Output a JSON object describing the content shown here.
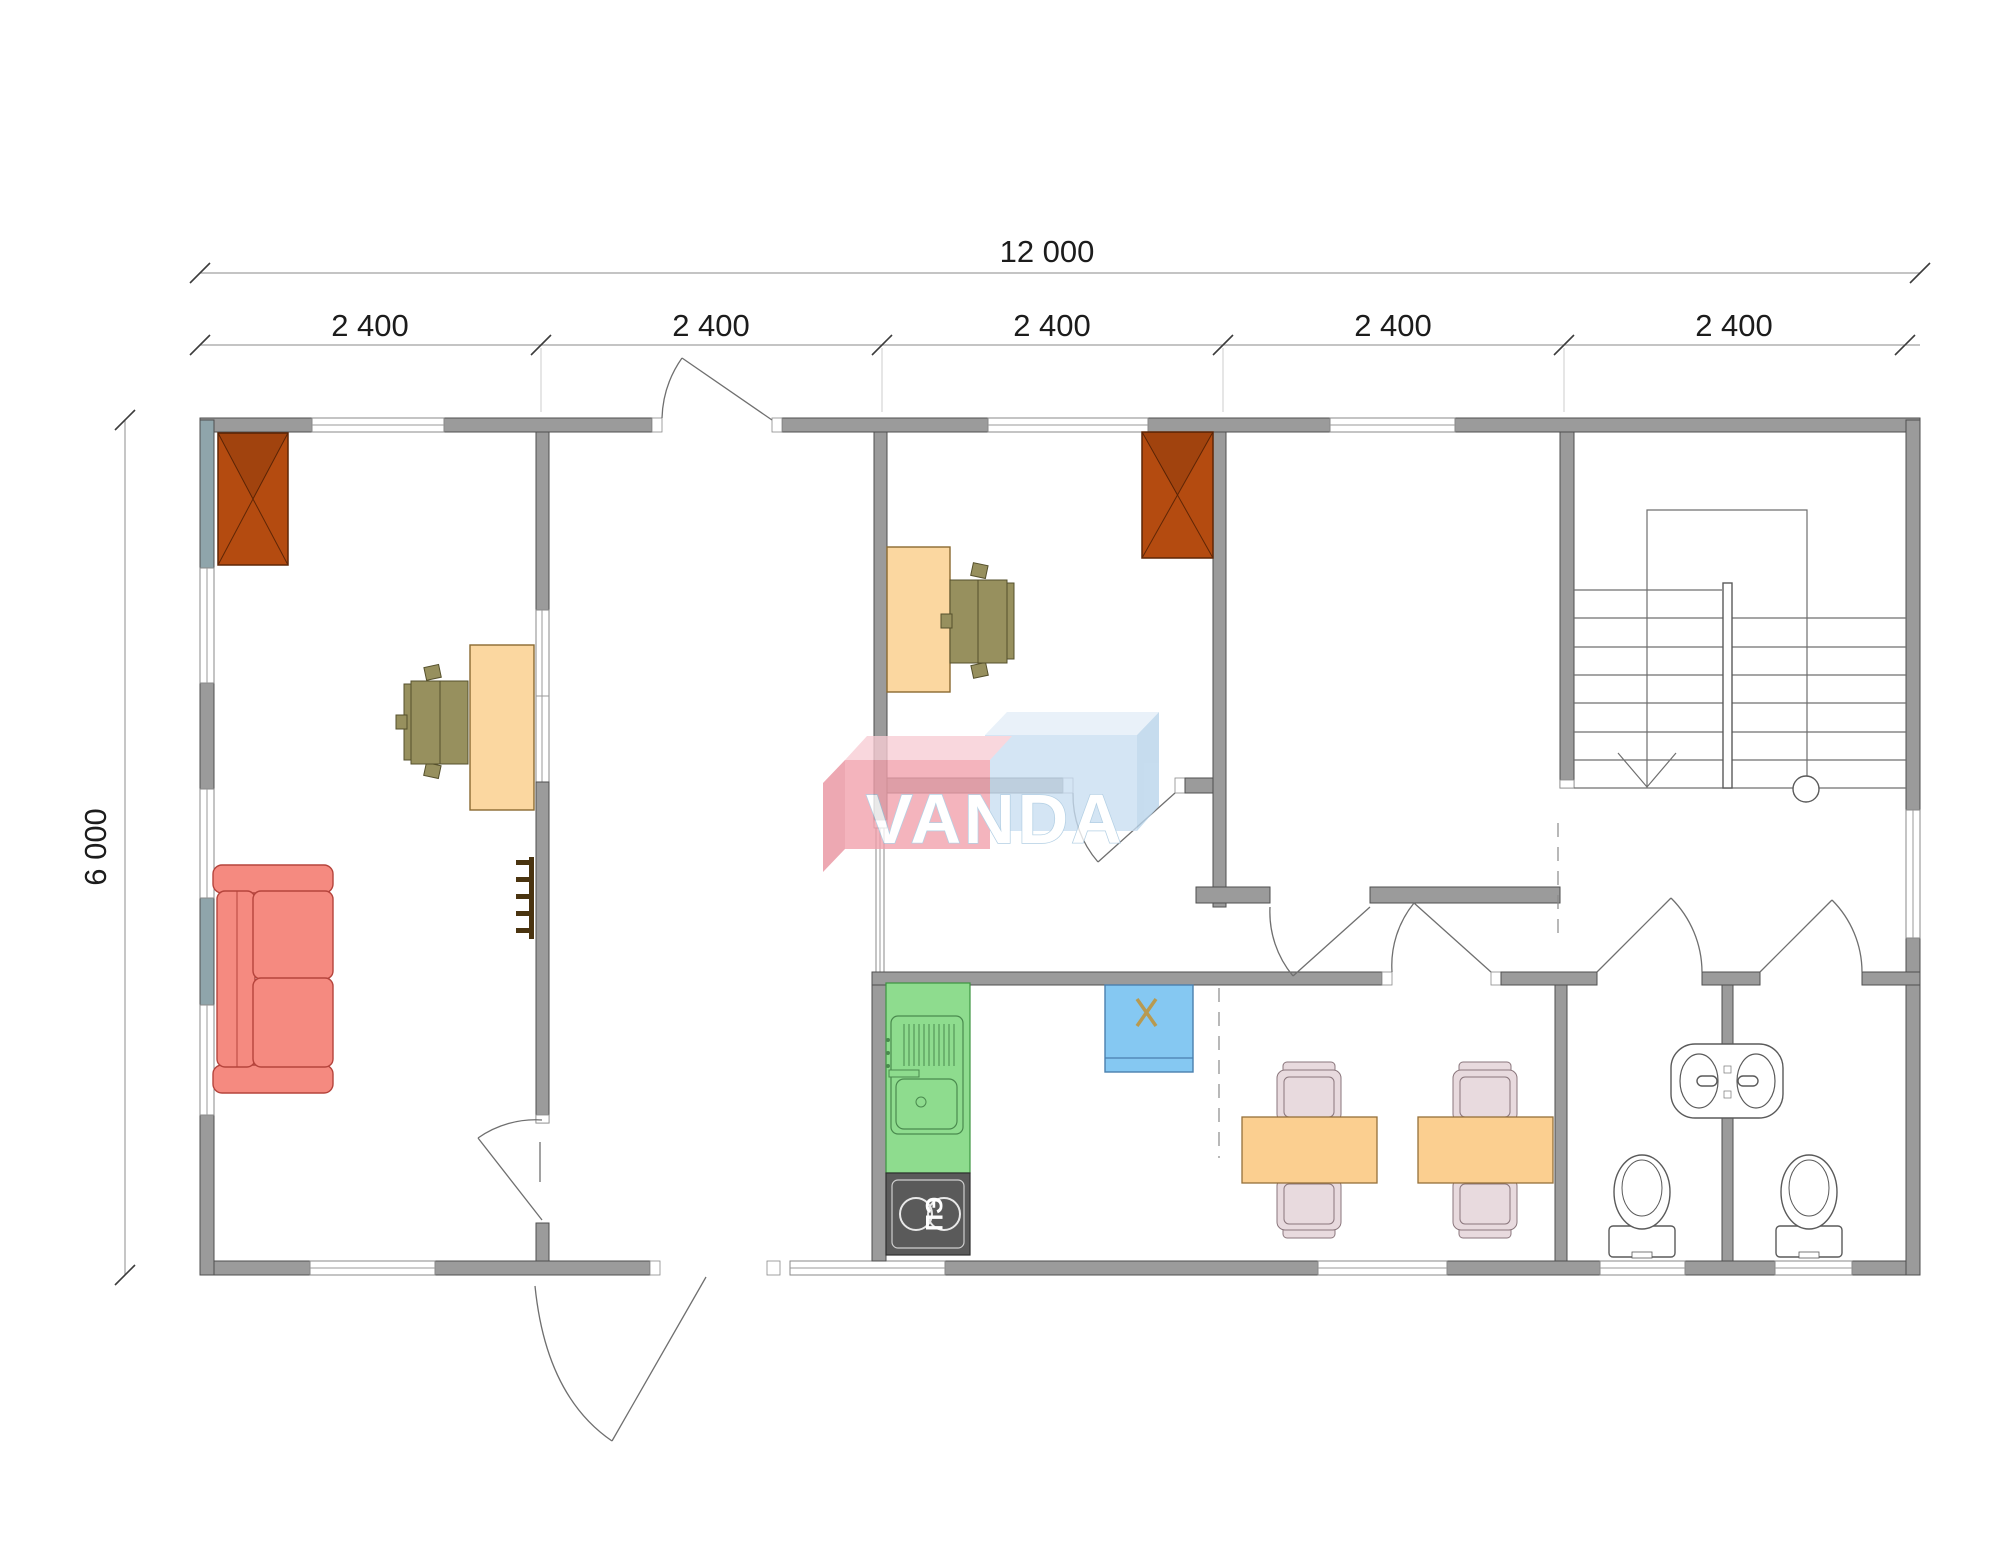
{
  "watermark": {
    "text": "VANDA",
    "brand_colors": {
      "pink_front": "#f19fab",
      "pink_top": "#f8ccd4",
      "blue_front": "#c8def2",
      "blue_top": "#e4eef8",
      "blue_side": "#b7d3ea"
    }
  },
  "dimensions": {
    "total_width_label": "12 000",
    "height_label": "6 000",
    "segment_labels": [
      "2 400",
      "2 400",
      "2 400",
      "2 400",
      "2 400"
    ],
    "overall_width_mm": 12000,
    "overall_depth_mm": 6000,
    "module_count": 5,
    "module_width_mm": 2400
  },
  "kitchen": {
    "stove_label": "ПЭ"
  },
  "plan": {
    "rooms": [
      {
        "name": "office-left",
        "furniture": [
          "wardrobe",
          "desk",
          "office-chair",
          "sofa",
          "coat-hooks"
        ]
      },
      {
        "name": "entrance-hall",
        "furniture": []
      },
      {
        "name": "office-center",
        "furniture": [
          "desk",
          "office-chair",
          "wardrobe"
        ]
      },
      {
        "name": "room-right",
        "furniture": []
      },
      {
        "name": "stair-hall",
        "furniture": [
          "staircase"
        ]
      },
      {
        "name": "kitchen-dining",
        "furniture": [
          "fridge",
          "sink-counter",
          "electric-stove",
          "dining-table",
          "dining-table",
          "dining-chairs"
        ]
      },
      {
        "name": "wc-1",
        "furniture": [
          "toilet",
          "wash-basin"
        ]
      },
      {
        "name": "wc-2",
        "furniture": [
          "toilet",
          "wash-basin"
        ]
      }
    ]
  },
  "colors": {
    "wall": "#9b9b9b",
    "wall_accent_blue": "#8fa5ab",
    "wardrobe": "#b44b10",
    "desk": "#fbd7a0",
    "office_chair": "#97905e",
    "sofa": "#f58a80",
    "kitchen_counter": "#8edc8e",
    "stove": "#5a5a5a",
    "fridge": "#85c8f2",
    "dining_table": "#fbcf90",
    "dining_chair": "#e8dade"
  }
}
